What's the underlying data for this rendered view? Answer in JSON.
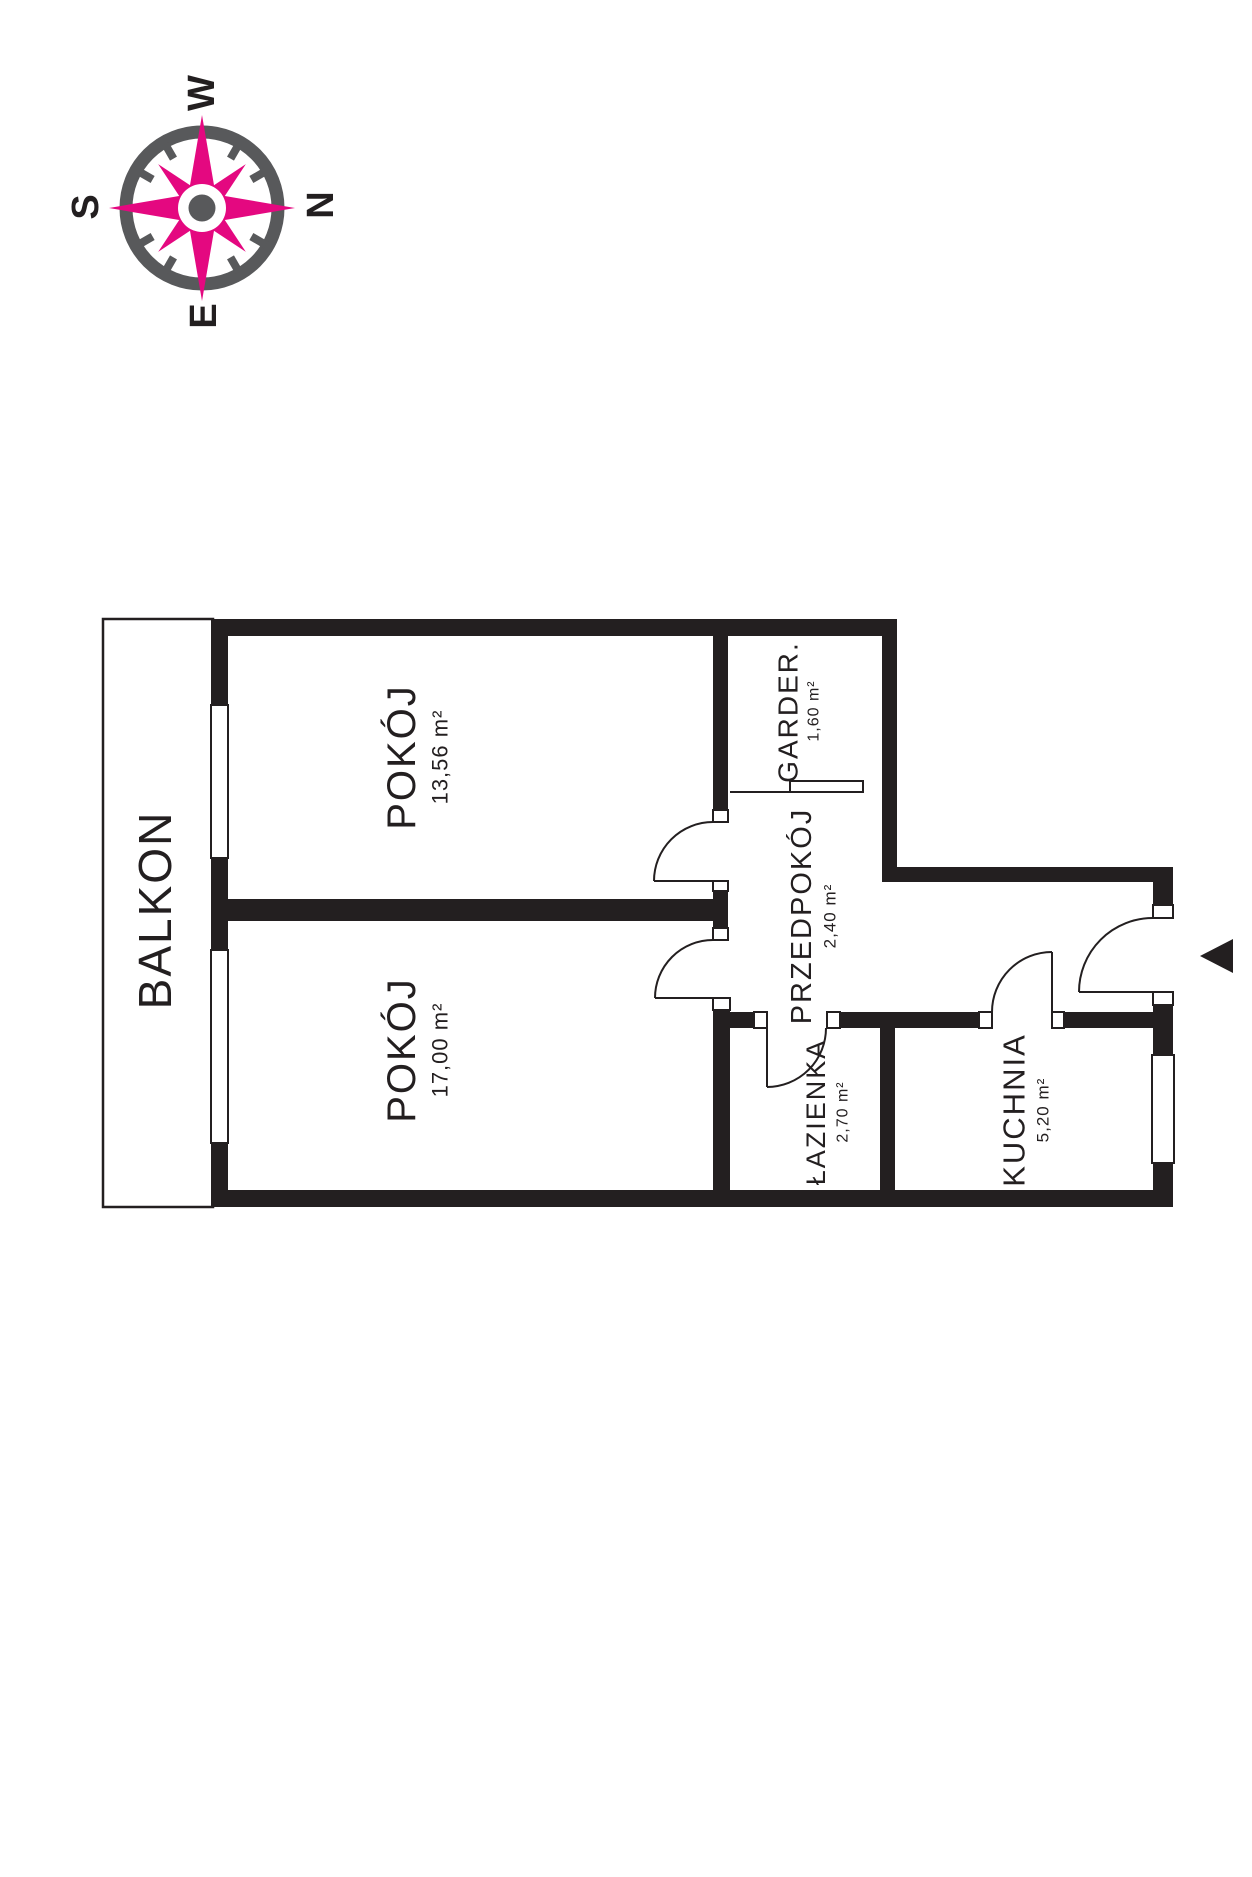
{
  "compass": {
    "icon": "compass-rose",
    "directions": {
      "top": "W",
      "right": "N",
      "bottom": "E",
      "left": "S"
    },
    "colors": {
      "accent_pink": "#E40880",
      "gray": "#58595B"
    }
  },
  "floorplan": {
    "wall_color": "#231F20",
    "entrance_arrow_direction": "left",
    "rooms": [
      {
        "name": "BALKON",
        "area": ""
      },
      {
        "name": "POKÓJ",
        "area": "13,56 m²"
      },
      {
        "name": "POKÓJ",
        "area": "17,00 m²"
      },
      {
        "name": "GARDER.",
        "area": "1,60 m²"
      },
      {
        "name": "PRZEDPOKÓJ",
        "area": "2,40 m²"
      },
      {
        "name": "ŁAZIENKA",
        "area": "2,70 m²"
      },
      {
        "name": "KUCHNIA",
        "area": "5,20 m²"
      }
    ]
  }
}
